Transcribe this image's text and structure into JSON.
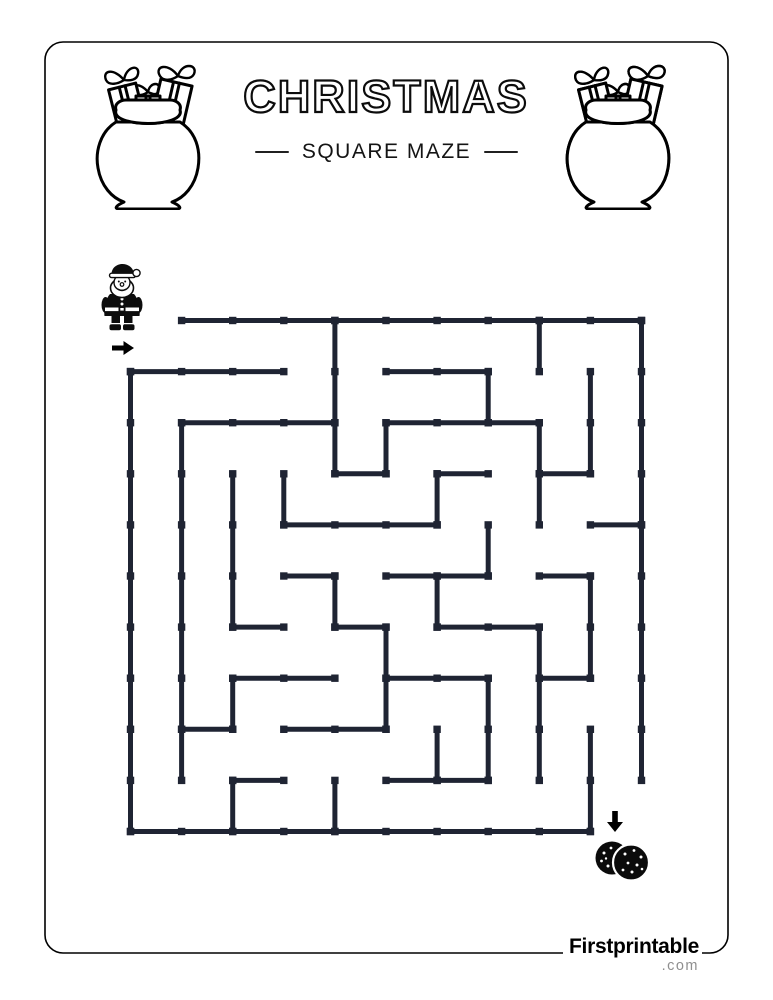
{
  "header": {
    "title": "CHRISTMAS",
    "subtitle": "SQUARE MAZE"
  },
  "decorations": {
    "left_icon": "gift-bag-icon",
    "right_icon": "gift-bag-icon"
  },
  "maze": {
    "rows": 10,
    "cols": 10,
    "cell_px": 51.1,
    "wall_color": "#1f2433",
    "wall_width": 5,
    "start": {
      "marker": "santa-icon",
      "arrow": "right-arrow-icon",
      "location": "outside top-left"
    },
    "end": {
      "marker": "cookies-icon",
      "arrow": "down-arrow-icon",
      "location": "outside bottom-right"
    },
    "h_walls": [
      [
        0,
        1,
        10
      ],
      [
        1,
        0,
        3
      ],
      [
        1,
        5,
        7
      ],
      [
        2,
        1,
        4
      ],
      [
        2,
        5,
        8
      ],
      [
        3,
        4,
        5
      ],
      [
        3,
        6,
        7
      ],
      [
        3,
        8,
        9
      ],
      [
        4,
        3,
        6
      ],
      [
        4,
        9,
        10
      ],
      [
        5,
        3,
        4
      ],
      [
        5,
        5,
        7
      ],
      [
        5,
        8,
        9
      ],
      [
        6,
        2,
        3
      ],
      [
        6,
        4,
        5
      ],
      [
        6,
        6,
        8
      ],
      [
        7,
        2,
        4
      ],
      [
        7,
        5,
        7
      ],
      [
        7,
        8,
        9
      ],
      [
        8,
        1,
        2
      ],
      [
        8,
        3,
        5
      ],
      [
        9,
        2,
        3
      ],
      [
        9,
        5,
        7
      ],
      [
        10,
        0,
        9
      ]
    ],
    "v_walls": [
      [
        0,
        1,
        10
      ],
      [
        1,
        2,
        9
      ],
      [
        2,
        3,
        6
      ],
      [
        2,
        7,
        8
      ],
      [
        2,
        9,
        10
      ],
      [
        3,
        3,
        4
      ],
      [
        4,
        0,
        3
      ],
      [
        4,
        5,
        6
      ],
      [
        4,
        9,
        10
      ],
      [
        5,
        2,
        3
      ],
      [
        5,
        6,
        8
      ],
      [
        6,
        3,
        4
      ],
      [
        6,
        5,
        6
      ],
      [
        6,
        8,
        9
      ],
      [
        7,
        1,
        2
      ],
      [
        7,
        4,
        5
      ],
      [
        7,
        7,
        9
      ],
      [
        8,
        0,
        1
      ],
      [
        8,
        2,
        4
      ],
      [
        8,
        6,
        9
      ],
      [
        9,
        1,
        3
      ],
      [
        9,
        5,
        7
      ],
      [
        9,
        8,
        10
      ],
      [
        10,
        0,
        9
      ]
    ]
  },
  "footer": {
    "brand": "Firstprintable",
    "brand_suffix": ".com"
  },
  "page": {
    "background": "#ffffff",
    "border_color": "#000000",
    "text_color": "#141414"
  }
}
